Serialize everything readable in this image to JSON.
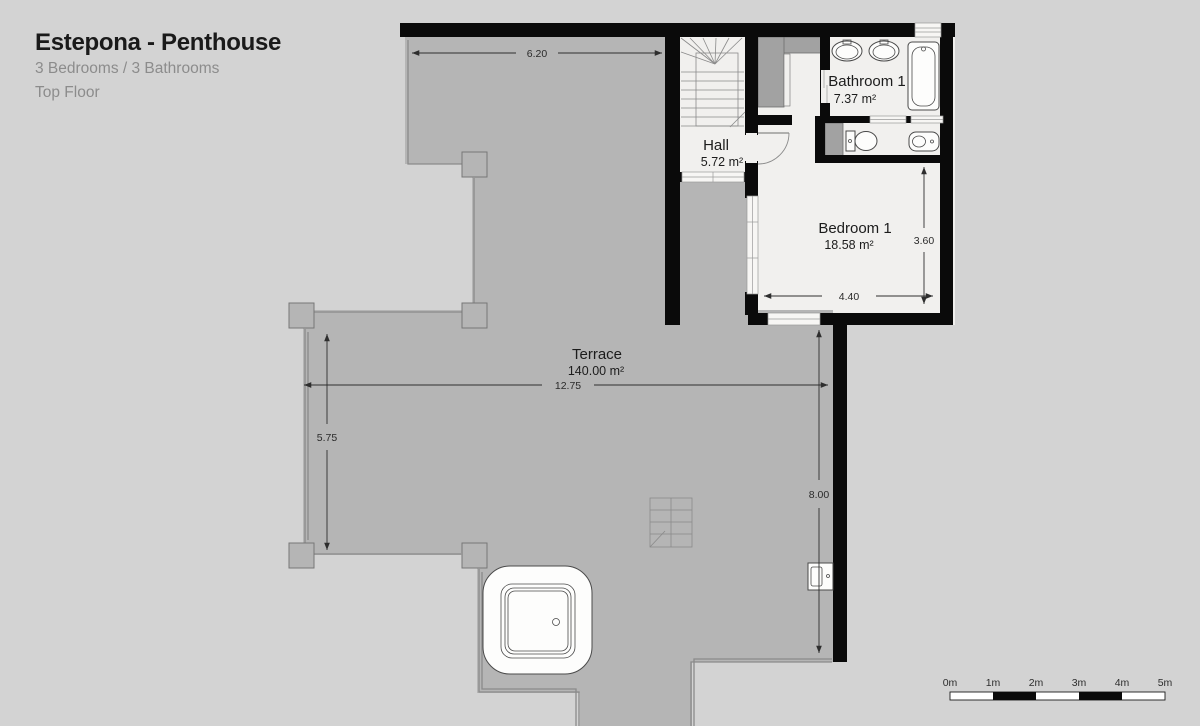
{
  "header": {
    "title": "Estepona - Penthouse",
    "subtitle": "3 Bedrooms / 3 Bathrooms",
    "floor": "Top Floor"
  },
  "rooms": {
    "bathroom1": {
      "name": "Bathroom 1",
      "area": "7.37 m²"
    },
    "hall": {
      "name": "Hall",
      "area": "5.72 m²"
    },
    "bedroom1": {
      "name": "Bedroom 1",
      "area": "18.58 m²"
    },
    "terrace": {
      "name": "Terrace",
      "area": "140.00 m²"
    }
  },
  "dimensions": {
    "terrace_top_width": "6.20",
    "bedroom_width": "4.40",
    "bedroom_height": "3.60",
    "terrace_width": "12.75",
    "terrace_left_height": "5.75",
    "terrace_right_height": "8.00"
  },
  "scale_bar": {
    "labels": [
      "0m",
      "1m",
      "2m",
      "3m",
      "4m",
      "5m"
    ]
  },
  "colors": {
    "background": "#d3d3d3",
    "terrace": "#b5b5b5",
    "room": "#f1f0ee",
    "wall": "#0a0a0a",
    "furniture_gray": "#a2a2a2",
    "text_dark": "#1c1c1c",
    "text_muted": "#8c8c8c"
  }
}
